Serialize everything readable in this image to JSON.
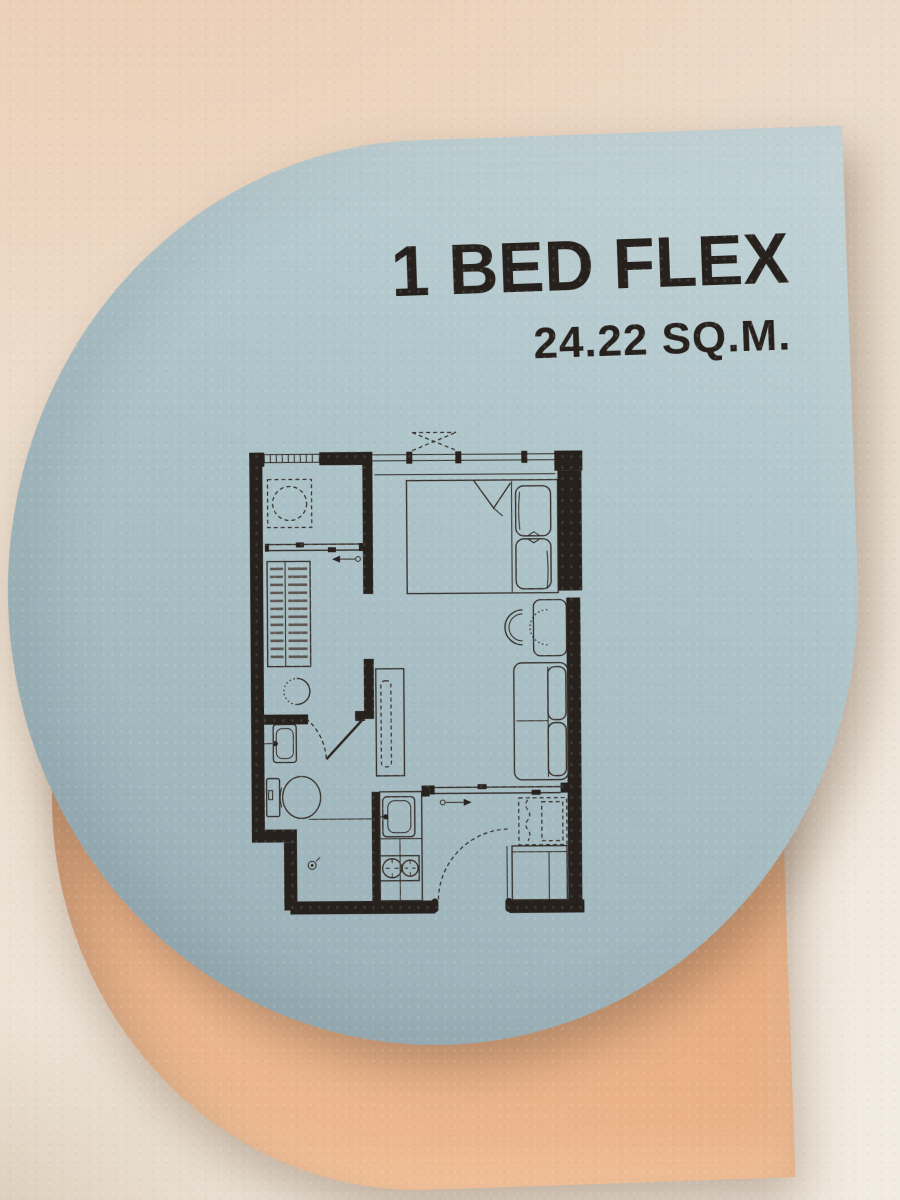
{
  "sign": {
    "title": "1 BED FLEX",
    "area": "24.22 SQ.M."
  },
  "theme": {
    "panel-blue": "#aec5ca",
    "panel-blue-light": "#c1d3d6",
    "panel-blue-dark": "#95aab2",
    "backdrop-peach": "#e6a87c",
    "backdrop-peach-light": "#f0bd95",
    "ink": "#27211d",
    "wall": "#ebdfd0",
    "wall-warm": "#ecd6c2"
  }
}
